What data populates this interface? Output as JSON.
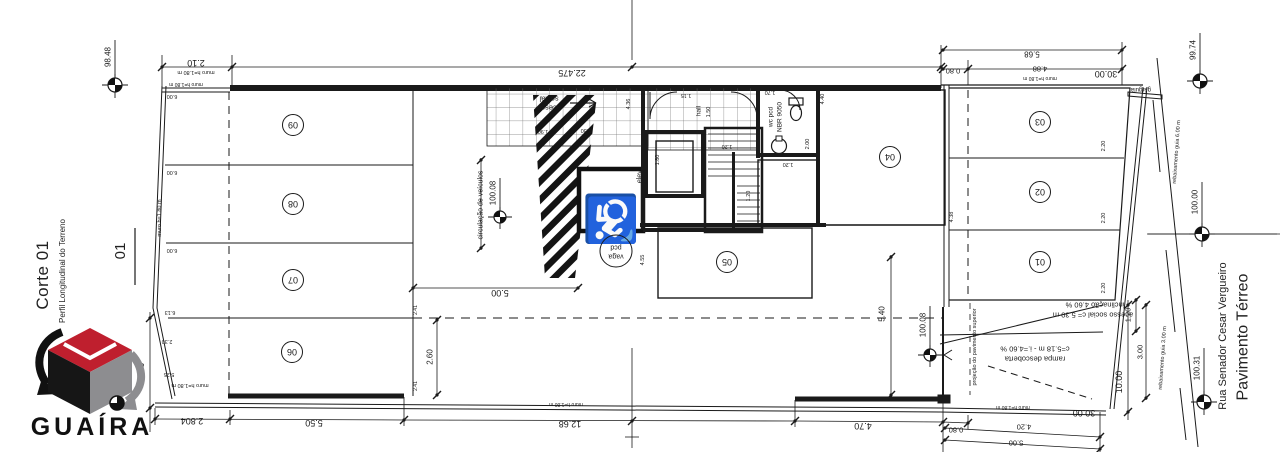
{
  "title_block": {
    "section_title": "Corte 01",
    "section_subtitle": "Perfil Longitudinal do Terreno",
    "section_mark": "01",
    "logo_text": "GUAÍRA",
    "logo_colors": {
      "top_face": "#bf1f2e",
      "left_face": "#161616",
      "right_face": "#8d8d90"
    }
  },
  "street": {
    "name": "Rua Senador Cesar Vergueiro",
    "level_label": "Pavimento Térreo"
  },
  "icons": {
    "wheelchair_icon": "♿",
    "level_marker_icon": "survey-benchmark-circle"
  },
  "levels": [
    {
      "value": "98.48",
      "cx": 115,
      "cy": 85,
      "ly": 40,
      "tx": 108,
      "ty": 57,
      "r": 7
    },
    {
      "value": "99.74",
      "cx": 1200,
      "cy": 81,
      "ly": 33,
      "tx": 1193,
      "ty": 50,
      "r": 7
    },
    {
      "value": "100.00",
      "cx": 1202,
      "cy": 234,
      "ly": 182,
      "tx": 1195,
      "ty": 202,
      "r": 7,
      "hline": true
    },
    {
      "value": "100.31",
      "cx": 1204,
      "cy": 402,
      "ly": 348,
      "tx": 1197,
      "ty": 368,
      "r": 7
    },
    {
      "value": "100.08",
      "cx": 500,
      "cy": 217,
      "ly": 178,
      "tx": 493,
      "ty": 193,
      "r": 6
    },
    {
      "value": "100.08",
      "cx": 930,
      "cy": 355,
      "ly": 306,
      "tx": 923,
      "ty": 325,
      "r": 6
    }
  ],
  "parking_stalls": [
    {
      "number": "09",
      "cx": 293,
      "cy": 125
    },
    {
      "number": "08",
      "cx": 293,
      "cy": 204
    },
    {
      "number": "07",
      "cx": 293,
      "cy": 280
    },
    {
      "number": "06",
      "cx": 292,
      "cy": 352
    },
    {
      "number": "05",
      "cx": 727,
      "cy": 262
    },
    {
      "number": "04",
      "cx": 890,
      "cy": 157
    },
    {
      "number": "03",
      "cx": 1040,
      "cy": 122
    },
    {
      "number": "02",
      "cx": 1040,
      "cy": 192
    },
    {
      "number": "01",
      "cx": 1040,
      "cy": 262
    }
  ],
  "annotations": [
    {
      "t": "2.10",
      "x": 196,
      "y": 63,
      "r": 180,
      "s": 9
    },
    {
      "t": "muro h=1.80 m",
      "x": 196,
      "y": 72,
      "r": 180,
      "s": 5.5
    },
    {
      "t": "22.475",
      "x": 572,
      "y": 73,
      "r": 180,
      "s": 9
    },
    {
      "t": "5.68",
      "x": 1032,
      "y": 54,
      "r": 180,
      "s": 8
    },
    {
      "t": "0.80",
      "x": 953,
      "y": 71,
      "r": 180,
      "s": 7.5
    },
    {
      "t": "4.88",
      "x": 1040,
      "y": 69,
      "r": 180,
      "s": 7.5
    },
    {
      "t": "muro h=1.80 m",
      "x": 1040,
      "y": 78,
      "r": 180,
      "s": 5
    },
    {
      "t": "30.00",
      "x": 1106,
      "y": 74,
      "r": 180,
      "s": 9
    },
    {
      "t": "muro h=1.80 m",
      "x": 186,
      "y": 84,
      "r": 180,
      "s": 5
    },
    {
      "t": "6.00",
      "x": 172,
      "y": 96,
      "r": 180,
      "s": 5.5
    },
    {
      "t": "6.00",
      "x": 172,
      "y": 172,
      "r": 180,
      "s": 5.5
    },
    {
      "t": "6.00",
      "x": 172,
      "y": 250,
      "r": 180,
      "s": 5.5
    },
    {
      "t": "6.13",
      "x": 170,
      "y": 312,
      "r": 180,
      "s": 5.5
    },
    {
      "t": "2.30",
      "x": 167,
      "y": 341,
      "r": 180,
      "s": 5.5
    },
    {
      "t": "5.25",
      "x": 169,
      "y": 374,
      "r": 180,
      "s": 5.5
    },
    {
      "t": "muro h=1.80 m",
      "x": 160,
      "y": 218,
      "r": -90,
      "s": 5.5
    },
    {
      "t": "muro h=1.80 m",
      "x": 190,
      "y": 385,
      "r": 180,
      "s": 5.5
    },
    {
      "t": "social",
      "x": 549,
      "y": 99,
      "r": 180,
      "s": 7.5,
      "n": "room-label"
    },
    {
      "t": "acesso",
      "x": 549,
      "y": 108,
      "r": 180,
      "s": 7.5,
      "n": "room-label"
    },
    {
      "t": "2.30",
      "x": 586,
      "y": 130,
      "r": 180,
      "s": 5.5
    },
    {
      "t": "1.90",
      "x": 543,
      "y": 131,
      "r": 180,
      "s": 5.5
    },
    {
      "t": "4.36",
      "x": 629,
      "y": 104,
      "r": -90,
      "s": 5.5
    },
    {
      "t": "1.15",
      "x": 686,
      "y": 95,
      "r": 180,
      "s": 5.5
    },
    {
      "t": "hall",
      "x": 699,
      "y": 111,
      "r": -90,
      "s": 6.5,
      "n": "room-label"
    },
    {
      "t": "1.50",
      "x": 709,
      "y": 112,
      "r": -90,
      "s": 5.5
    },
    {
      "t": "1.70",
      "x": 770,
      "y": 92,
      "r": 180,
      "s": 5.5
    },
    {
      "t": "wc pcd",
      "x": 771,
      "y": 117,
      "r": -90,
      "s": 6.5,
      "n": "room-label"
    },
    {
      "t": "NBR 9050",
      "x": 780,
      "y": 117,
      "r": -90,
      "s": 6.5,
      "n": "room-label"
    },
    {
      "t": "2.00",
      "x": 808,
      "y": 144,
      "r": -90,
      "s": 5.5
    },
    {
      "t": "elev.",
      "x": 640,
      "y": 176,
      "r": -90,
      "s": 7,
      "n": "room-label"
    },
    {
      "t": "1.80",
      "x": 658,
      "y": 160,
      "r": -90,
      "s": 5.5
    },
    {
      "t": "1.20",
      "x": 727,
      "y": 146,
      "r": 180,
      "s": 5.5
    },
    {
      "t": "1.20",
      "x": 749,
      "y": 196,
      "r": -90,
      "s": 5.5
    },
    {
      "t": "1.20",
      "x": 788,
      "y": 164,
      "r": 180,
      "s": 5.5
    },
    {
      "t": "4.40",
      "x": 823,
      "y": 99,
      "r": -90,
      "s": 5.5
    },
    {
      "t": "4.38",
      "x": 952,
      "y": 217,
      "r": -90,
      "s": 5.5
    },
    {
      "t": "4.55",
      "x": 643,
      "y": 260,
      "r": -90,
      "s": 5.5
    },
    {
      "t": "circulação de veículos",
      "x": 481,
      "y": 205,
      "r": -90,
      "s": 7,
      "n": "zone-label"
    },
    {
      "t": "5.00",
      "x": 500,
      "y": 293,
      "r": 180,
      "s": 9
    },
    {
      "t": "2.60",
      "x": 430,
      "y": 357,
      "r": -90,
      "s": 8
    },
    {
      "t": "2.41",
      "x": 416,
      "y": 310,
      "r": -90,
      "s": 5
    },
    {
      "t": "2.41",
      "x": 416,
      "y": 386,
      "r": -90,
      "s": 5
    },
    {
      "t": "5.40",
      "x": 882,
      "y": 314,
      "r": -90,
      "s": 8
    },
    {
      "t": "2.20",
      "x": 1104,
      "y": 146,
      "r": -90,
      "s": 5.5
    },
    {
      "t": "2.20",
      "x": 1104,
      "y": 218,
      "r": -90,
      "s": 5.5
    },
    {
      "t": "2.20",
      "x": 1104,
      "y": 288,
      "r": -90,
      "s": 5.5
    },
    {
      "t": "gárgula",
      "x": 1141,
      "y": 89,
      "r": 180,
      "s": 6,
      "n": "note-label"
    },
    {
      "t": "inclinação 4.60 %",
      "x": 1095,
      "y": 305,
      "r": 180,
      "s": 7.5,
      "n": "note-label"
    },
    {
      "t": "acesso social c= 5.30 m",
      "x": 1093,
      "y": 315,
      "r": 180,
      "s": 7.5,
      "n": "note-label"
    },
    {
      "t": "c=5.18 m - i.=4.60 %",
      "x": 1035,
      "y": 349,
      "r": 180,
      "s": 7.5,
      "n": "note-label"
    },
    {
      "t": "rampa descoberta",
      "x": 1035,
      "y": 359,
      "r": 180,
      "s": 7.5,
      "n": "note-label"
    },
    {
      "t": "projeção do pavimento superior",
      "x": 975,
      "y": 347,
      "r": -90,
      "s": 5.5,
      "n": "note-label"
    },
    {
      "t": "10.00",
      "x": 141,
      "y": 374,
      "r": -90,
      "s": 9
    },
    {
      "t": "10.00",
      "x": 1119,
      "y": 382,
      "r": -90,
      "s": 9
    },
    {
      "t": "1.20",
      "x": 1128,
      "y": 315,
      "r": -90,
      "s": 7.5
    },
    {
      "t": "3.00",
      "x": 1140,
      "y": 352,
      "r": -90,
      "s": 7.5
    },
    {
      "t": "2.804",
      "x": 192,
      "y": 421,
      "r": 180,
      "s": 9
    },
    {
      "t": "5.50",
      "x": 314,
      "y": 423,
      "r": 180,
      "s": 9
    },
    {
      "t": "12.68",
      "x": 570,
      "y": 424,
      "r": 180,
      "s": 9
    },
    {
      "t": "muro h=1.80 m",
      "x": 566,
      "y": 404,
      "r": 180,
      "s": 5
    },
    {
      "t": "4.70",
      "x": 863,
      "y": 426,
      "r": 180,
      "s": 9
    },
    {
      "t": "0.80",
      "x": 956,
      "y": 430,
      "r": 180,
      "s": 7.5
    },
    {
      "t": "4.20",
      "x": 1024,
      "y": 427,
      "r": 180,
      "s": 7.5
    },
    {
      "t": "5.00",
      "x": 1016,
      "y": 443,
      "r": 180,
      "s": 7.5
    },
    {
      "t": "30.00",
      "x": 1084,
      "y": 413,
      "r": 180,
      "s": 9
    },
    {
      "t": "muro h=1.80 m",
      "x": 1013,
      "y": 407,
      "r": 180,
      "s": 5
    },
    {
      "t": "rebaixamento guia 6.00 m",
      "x": 1177,
      "y": 152,
      "r": -86,
      "s": 5.5,
      "n": "note-label"
    },
    {
      "t": "rebaixamento guia 3.00 m",
      "x": 1163,
      "y": 358,
      "r": -86,
      "s": 5.5,
      "n": "note-label"
    },
    {
      "t": "pcd",
      "x": 616,
      "y": 247,
      "r": 180,
      "s": 7,
      "n": "zone-label"
    },
    {
      "t": "vaga",
      "x": 616,
      "y": 256,
      "r": 180,
      "s": 7,
      "n": "zone-label"
    }
  ]
}
